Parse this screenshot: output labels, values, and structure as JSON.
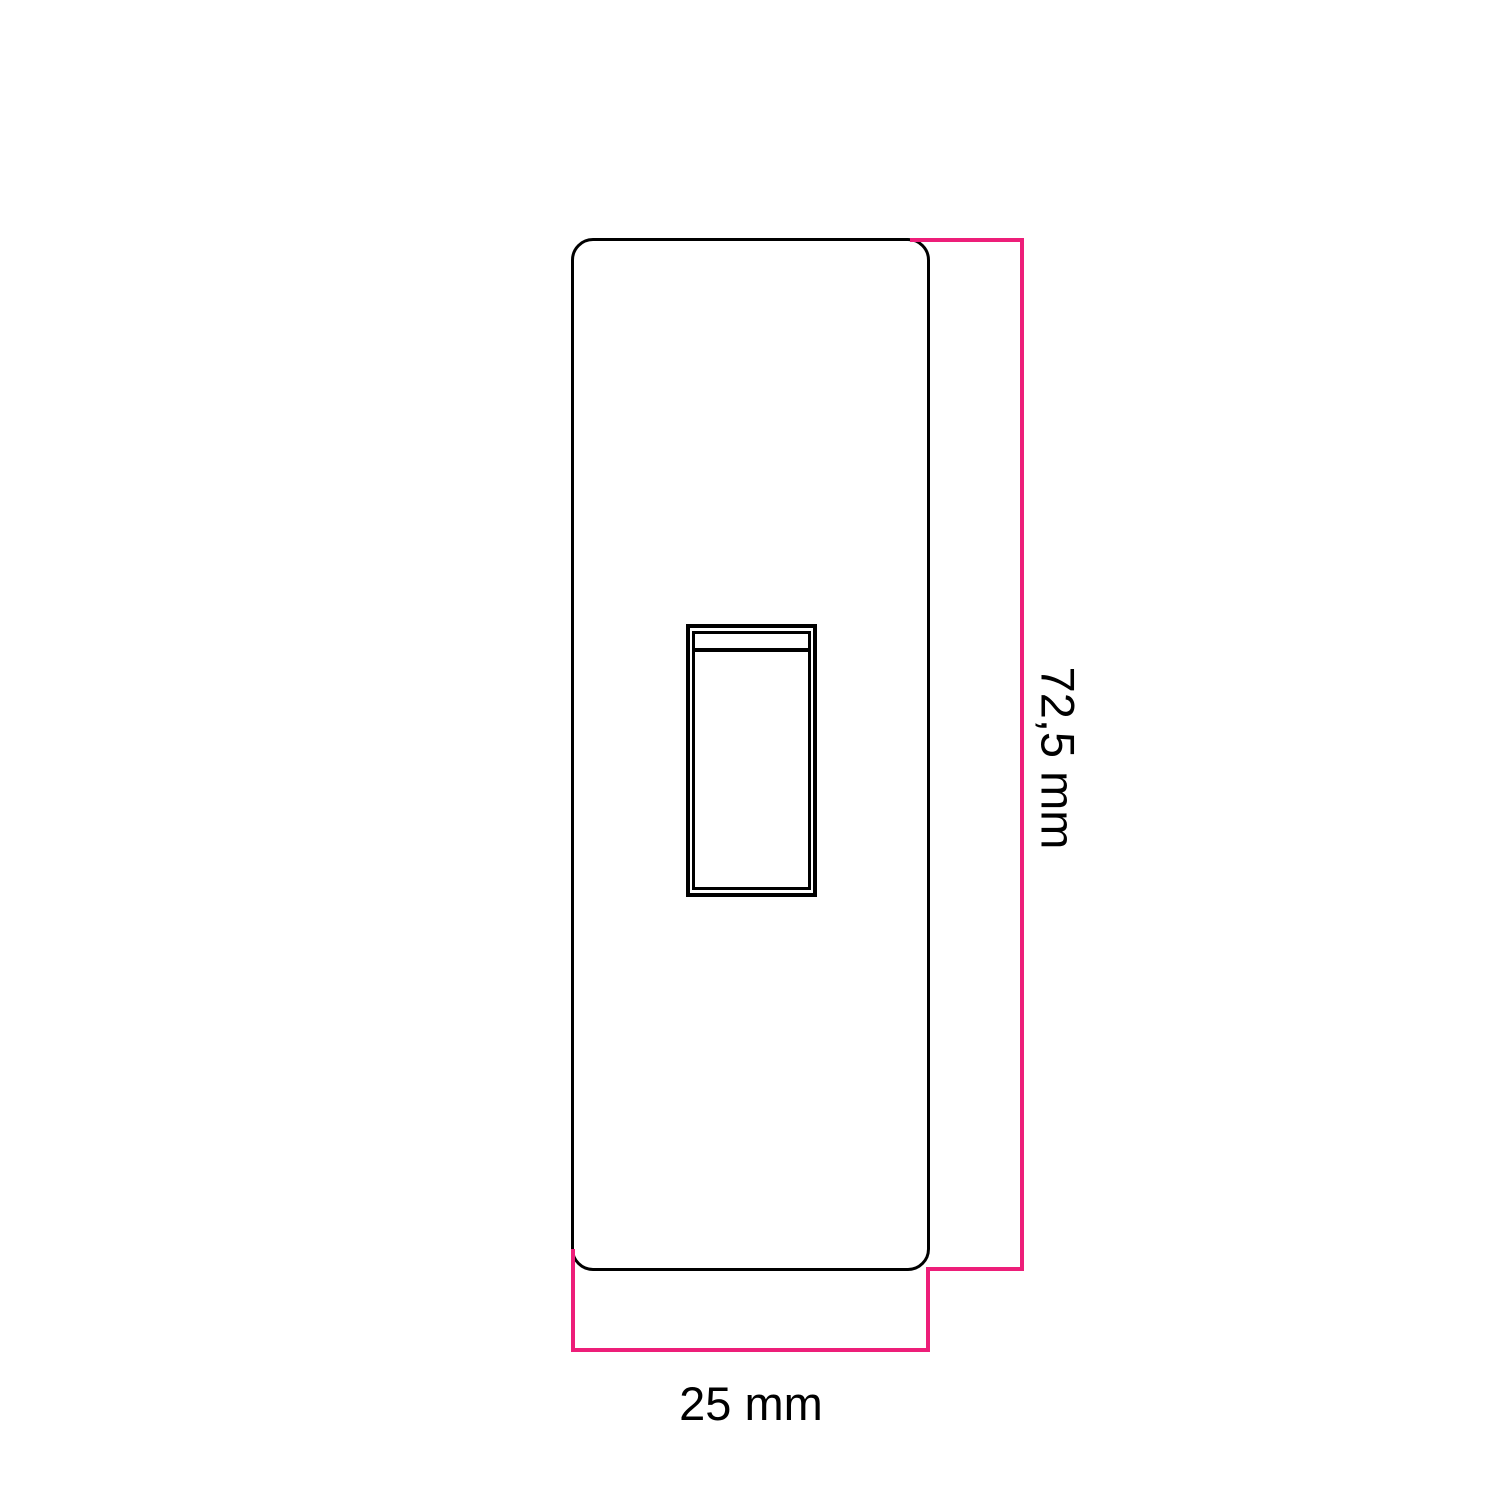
{
  "diagram": {
    "dimensions": {
      "height": {
        "label": "72,5 mm",
        "value": 72.5,
        "unit": "mm"
      },
      "width": {
        "label": "25 mm",
        "value": 25,
        "unit": "mm"
      }
    },
    "colors": {
      "dimension_line": "#ED1E79",
      "outline": "#000000",
      "background": "#FFFFFF"
    }
  }
}
